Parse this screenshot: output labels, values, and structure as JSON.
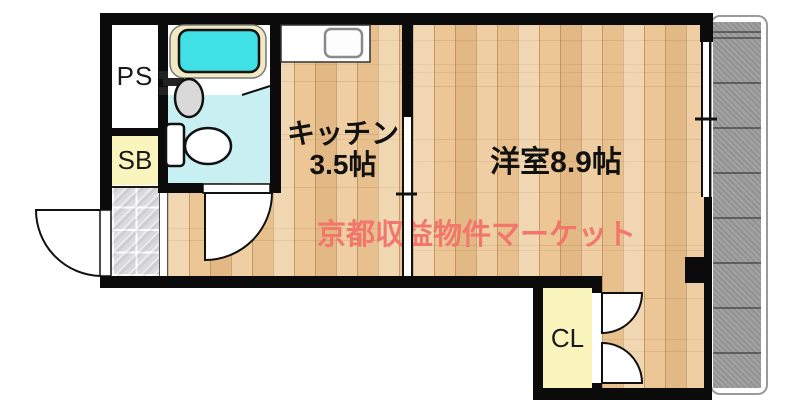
{
  "floorplan": {
    "watermark": {
      "text": "京都収益物件マーケット",
      "color": "#f2766b"
    },
    "labels": {
      "kitchen_name": "キッチン",
      "kitchen_size": "3.5帖",
      "living_room": "洋室8.9帖",
      "pipe_space": "PS",
      "shoe_box": "SB",
      "closet": "CL"
    },
    "colors": {
      "wall": "#0b0b0b",
      "wood_floor": "#ecc795",
      "bath_floor": "#c8f0f2",
      "bath_water": "#3fe0e6",
      "bathtub_rim": "#f1e9c4",
      "storage_yellow": "#faf5bc",
      "balcony_gray": "#9b9b9b",
      "entry_tile": "#dadadd",
      "watermark_salmon": "#f2766b"
    },
    "fixtures": [
      "bathtub",
      "washbasin",
      "toilet",
      "kitchen-counter",
      "kitchen-sink",
      "entry-door",
      "bathroom-door",
      "sliding-door",
      "closet-double-doors",
      "window",
      "balcony",
      "entry-tiles",
      "step-edge"
    ]
  }
}
